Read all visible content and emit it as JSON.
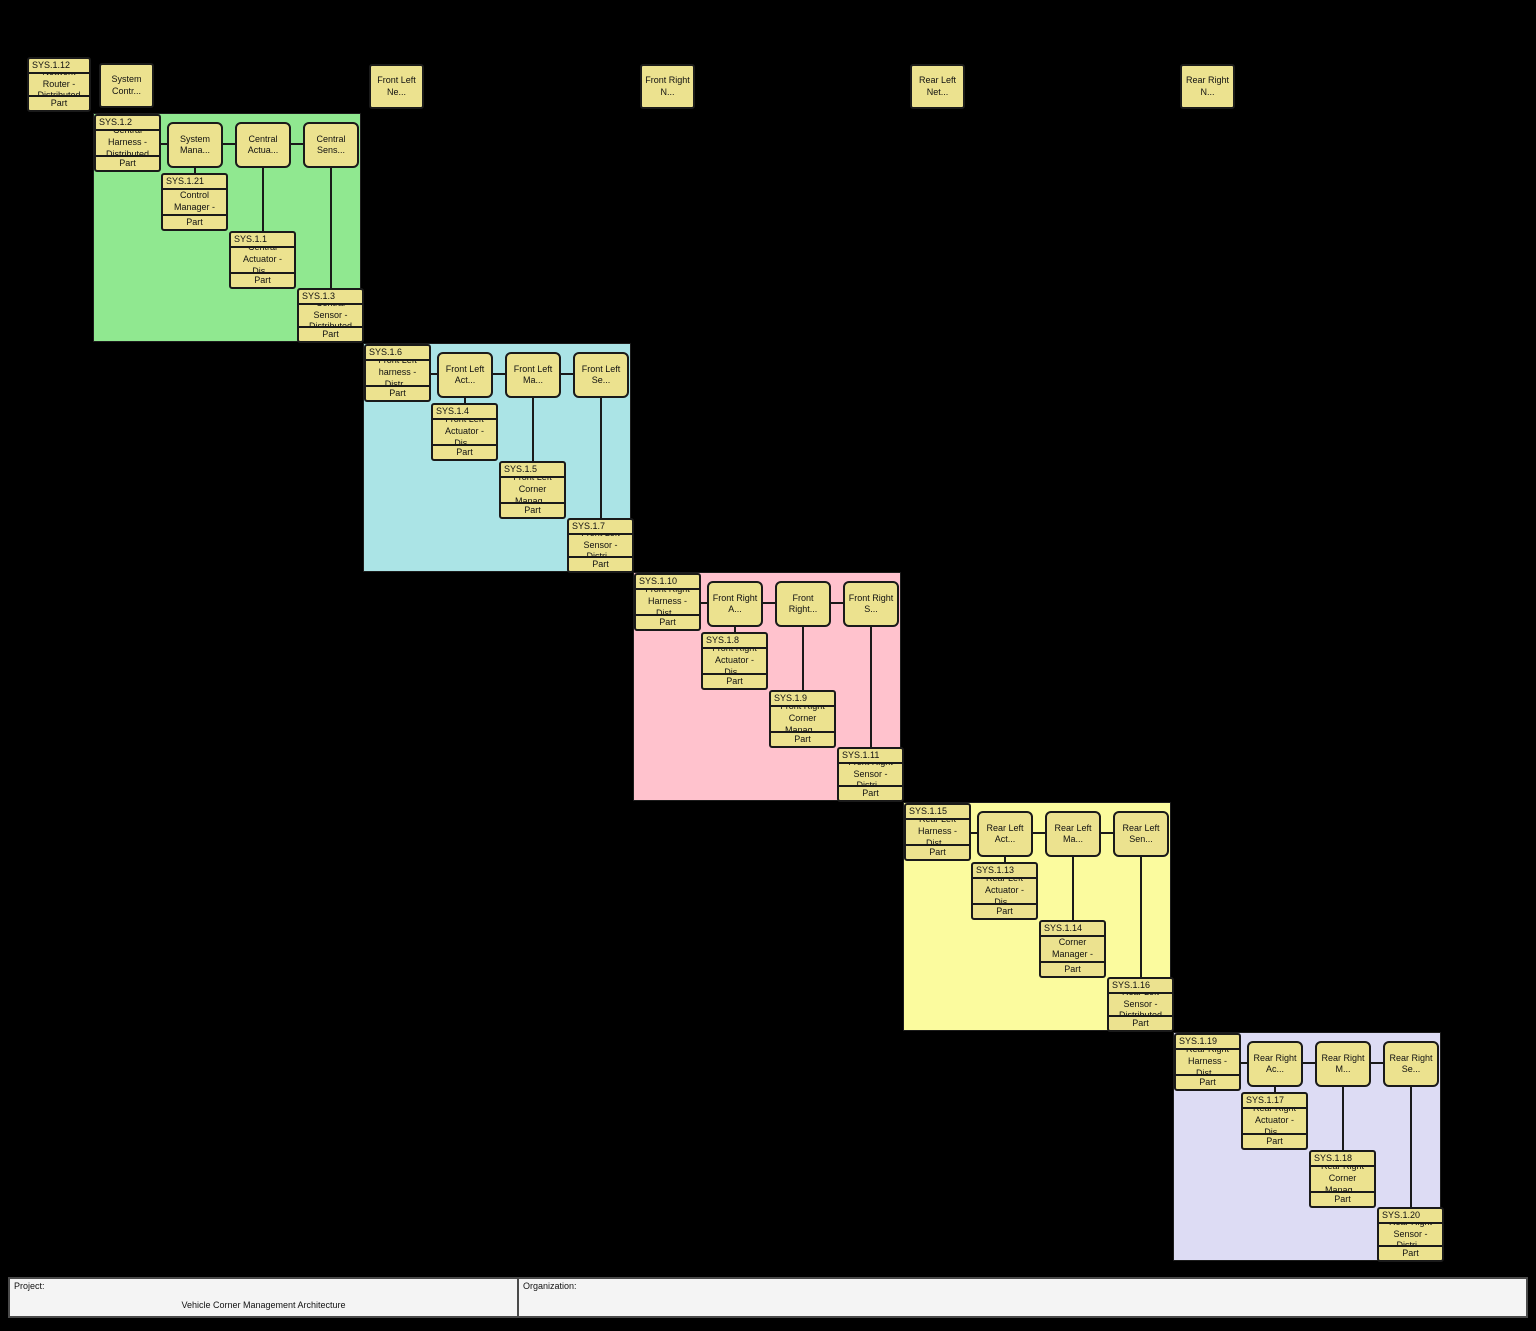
{
  "canvas": {
    "background": "#000000",
    "node_fill": "#ece28f",
    "node_border": "#1a1a1a"
  },
  "top_nodes": {
    "router": {
      "id": "SYS.1.12",
      "name": "Network Router - Distributed",
      "kind": "Part"
    },
    "simple": [
      {
        "label": "System Contr..."
      },
      {
        "label": "Front Left Ne..."
      },
      {
        "label": "Front Right N..."
      },
      {
        "label": "Rear Left Net..."
      },
      {
        "label": "Rear Right N..."
      }
    ]
  },
  "regions": [
    {
      "name": "Central",
      "color": "#90e890",
      "harness": {
        "id": "SYS.1.2",
        "name": "Central Harness - Distributed",
        "kind": "Part"
      },
      "chain": [
        "System Mana...",
        "Central Actua...",
        "Central Sens..."
      ],
      "parts": [
        {
          "id": "SYS.1.21",
          "name": "System Control Manager - Dis...",
          "kind": "Part"
        },
        {
          "id": "SYS.1.1",
          "name": "Central Actuator - Dis...",
          "kind": "Part"
        },
        {
          "id": "SYS.1.3",
          "name": "Central Sensor - Distributed",
          "kind": "Part"
        }
      ]
    },
    {
      "name": "Front Left",
      "color": "#abe4e6",
      "harness": {
        "id": "SYS.1.6",
        "name": "Front Left harness - Distr...",
        "kind": "Part"
      },
      "chain": [
        "Front Left Act...",
        "Front Left Ma...",
        "Front Left Se..."
      ],
      "parts": [
        {
          "id": "SYS.1.4",
          "name": "Front Left Actuator - Dis...",
          "kind": "Part"
        },
        {
          "id": "SYS.1.5",
          "name": "Front Left Corner Manag...",
          "kind": "Part"
        },
        {
          "id": "SYS.1.7",
          "name": "Front Left Sensor - Distri...",
          "kind": "Part"
        }
      ]
    },
    {
      "name": "Front Right",
      "color": "#ffc2cd",
      "harness": {
        "id": "SYS.1.10",
        "name": "Front Right Harness - Dist...",
        "kind": "Part"
      },
      "chain": [
        "Front Right A...",
        "Front Right...",
        "Front Right S..."
      ],
      "parts": [
        {
          "id": "SYS.1.8",
          "name": "Front Right Actuator - Dis...",
          "kind": "Part"
        },
        {
          "id": "SYS.1.9",
          "name": "Front Right Corner Manag...",
          "kind": "Part"
        },
        {
          "id": "SYS.1.11",
          "name": "Front Right Sensor - Distri...",
          "kind": "Part"
        }
      ]
    },
    {
      "name": "Rear Left",
      "color": "#fbfb9e",
      "harness": {
        "id": "SYS.1.15",
        "name": "Rear Left Harness - Dist...",
        "kind": "Part"
      },
      "chain": [
        "Rear Left Act...",
        "Rear Left Ma...",
        "Rear Left Sen..."
      ],
      "parts": [
        {
          "id": "SYS.1.13",
          "name": "Rear Left Actuator - Dis...",
          "kind": "Part"
        },
        {
          "id": "SYS.1.14",
          "name": "Rear Left Corner Manager - Dis...",
          "kind": "Part"
        },
        {
          "id": "SYS.1.16",
          "name": "Rear Left Sensor - Distributed",
          "kind": "Part"
        }
      ]
    },
    {
      "name": "Rear Right",
      "color": "#dddcf4",
      "harness": {
        "id": "SYS.1.19",
        "name": "Rear Right Harness - Dist...",
        "kind": "Part"
      },
      "chain": [
        "Rear Right Ac...",
        "Rear Right M...",
        "Rear Right Se..."
      ],
      "parts": [
        {
          "id": "SYS.1.17",
          "name": "Rear Right Actuator - Dis...",
          "kind": "Part"
        },
        {
          "id": "SYS.1.18",
          "name": "Rear Right Corner Manag...",
          "kind": "Part"
        },
        {
          "id": "SYS.1.20",
          "name": "Rear Right Sensor - Distri...",
          "kind": "Part"
        }
      ]
    }
  ],
  "title_block": {
    "project_label": "Project:",
    "project_value": "Vehicle Corner Management Architecture",
    "organization_label": "Organization:",
    "organization_value": ""
  }
}
